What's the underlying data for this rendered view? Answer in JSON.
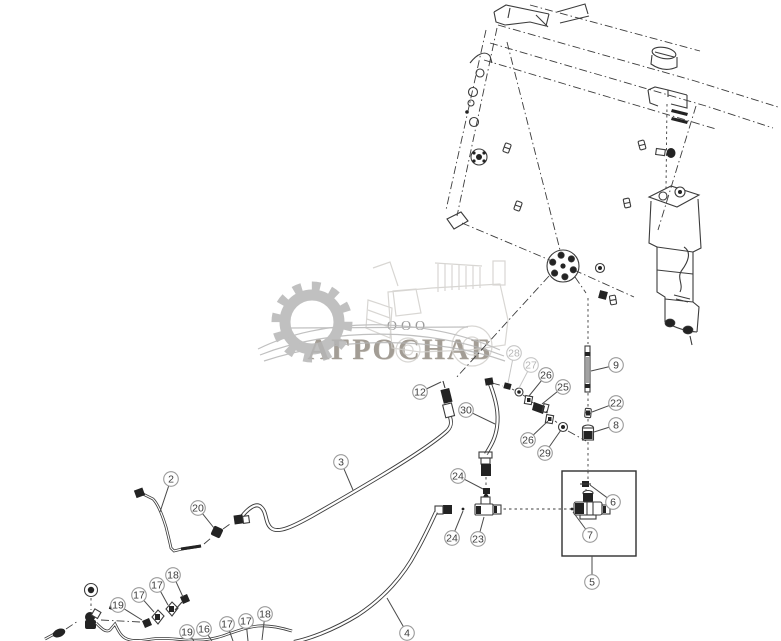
{
  "watermark": {
    "org_form": "ООО",
    "company": "АГРОСНАБ"
  },
  "colors": {
    "line": "#3c3c3c",
    "leader": "#4a4a4a",
    "callout_stroke": "#9a9a9a",
    "callout_fill": "#ffffff",
    "callout_text": "#3d3d3d",
    "muted_stroke": "#c6c6c6",
    "muted_text": "#b5b5b5",
    "watermark_gray": "#b6b6b6",
    "watermark_light": "#d2d0cc",
    "watermark_text": "#a39d95",
    "wm_text2": "#9a9a9a"
  },
  "callouts": [
    {
      "label": "2",
      "x": 171,
      "y": 479,
      "lx": 160,
      "ly": 512,
      "muted": false
    },
    {
      "label": "20",
      "x": 198,
      "y": 508,
      "lx": 214,
      "ly": 528,
      "muted": false
    },
    {
      "label": "3",
      "x": 341,
      "y": 462,
      "lx": 353,
      "ly": 490,
      "muted": false
    },
    {
      "label": "12",
      "x": 420,
      "y": 392,
      "lx": 441,
      "ly": 382,
      "muted": false
    },
    {
      "label": "30",
      "x": 466,
      "y": 410,
      "lx": 495,
      "ly": 424,
      "muted": false
    },
    {
      "label": "28",
      "x": 514,
      "y": 353,
      "lx": 508,
      "ly": 383,
      "muted": true
    },
    {
      "label": "27",
      "x": 531,
      "y": 365,
      "lx": 519,
      "ly": 388,
      "muted": true
    },
    {
      "label": "26",
      "x": 546,
      "y": 375,
      "lx": 529,
      "ly": 396,
      "muted": false
    },
    {
      "label": "25",
      "x": 563,
      "y": 387,
      "lx": 542,
      "ly": 404,
      "muted": false
    },
    {
      "label": "9",
      "x": 616,
      "y": 365,
      "lx": 591,
      "ly": 371,
      "muted": false
    },
    {
      "label": "22",
      "x": 616,
      "y": 403,
      "lx": 592,
      "ly": 412,
      "muted": false
    },
    {
      "label": "8",
      "x": 616,
      "y": 425,
      "lx": 594,
      "ly": 432,
      "muted": false
    },
    {
      "label": "26",
      "x": 528,
      "y": 440,
      "lx": 548,
      "ly": 421,
      "muted": false
    },
    {
      "label": "29",
      "x": 545,
      "y": 453,
      "lx": 561,
      "ly": 430,
      "muted": false
    },
    {
      "label": "24",
      "x": 458,
      "y": 476,
      "lx": 483,
      "ly": 489,
      "muted": false
    },
    {
      "label": "24",
      "x": 452,
      "y": 538,
      "lx": 463,
      "ly": 511,
      "muted": false
    },
    {
      "label": "23",
      "x": 478,
      "y": 539,
      "lx": 484,
      "ly": 517,
      "muted": false
    },
    {
      "label": "6",
      "x": 613,
      "y": 502,
      "lx": 590,
      "ly": 485,
      "muted": false
    },
    {
      "label": "7",
      "x": 590,
      "y": 535,
      "lx": 573,
      "ly": 512,
      "muted": false
    },
    {
      "label": "5",
      "x": 592,
      "y": 582,
      "lx": 592,
      "ly": 556,
      "muted": false
    },
    {
      "label": "19",
      "x": 118,
      "y": 605,
      "lx": 142,
      "ly": 620,
      "muted": false
    },
    {
      "label": "17",
      "x": 139,
      "y": 595,
      "lx": 154,
      "ly": 612,
      "muted": false
    },
    {
      "label": "17",
      "x": 157,
      "y": 585,
      "lx": 168,
      "ly": 605,
      "muted": false
    },
    {
      "label": "18",
      "x": 173,
      "y": 575,
      "lx": 183,
      "ly": 597,
      "muted": false
    },
    {
      "label": "19",
      "x": 187,
      "y": 632,
      "lx": 194,
      "ly": 641,
      "muted": false
    },
    {
      "label": "16",
      "x": 204,
      "y": 629,
      "lx": 212,
      "ly": 641,
      "muted": false
    },
    {
      "label": "17",
      "x": 227,
      "y": 624,
      "lx": 233,
      "ly": 641,
      "muted": false
    },
    {
      "label": "17",
      "x": 246,
      "y": 621,
      "lx": 248,
      "ly": 641,
      "muted": false
    },
    {
      "label": "18",
      "x": 265,
      "y": 614,
      "lx": 262,
      "ly": 640,
      "muted": false
    },
    {
      "label": "4",
      "x": 407,
      "y": 633,
      "lx": 387,
      "ly": 598,
      "muted": false
    }
  ]
}
